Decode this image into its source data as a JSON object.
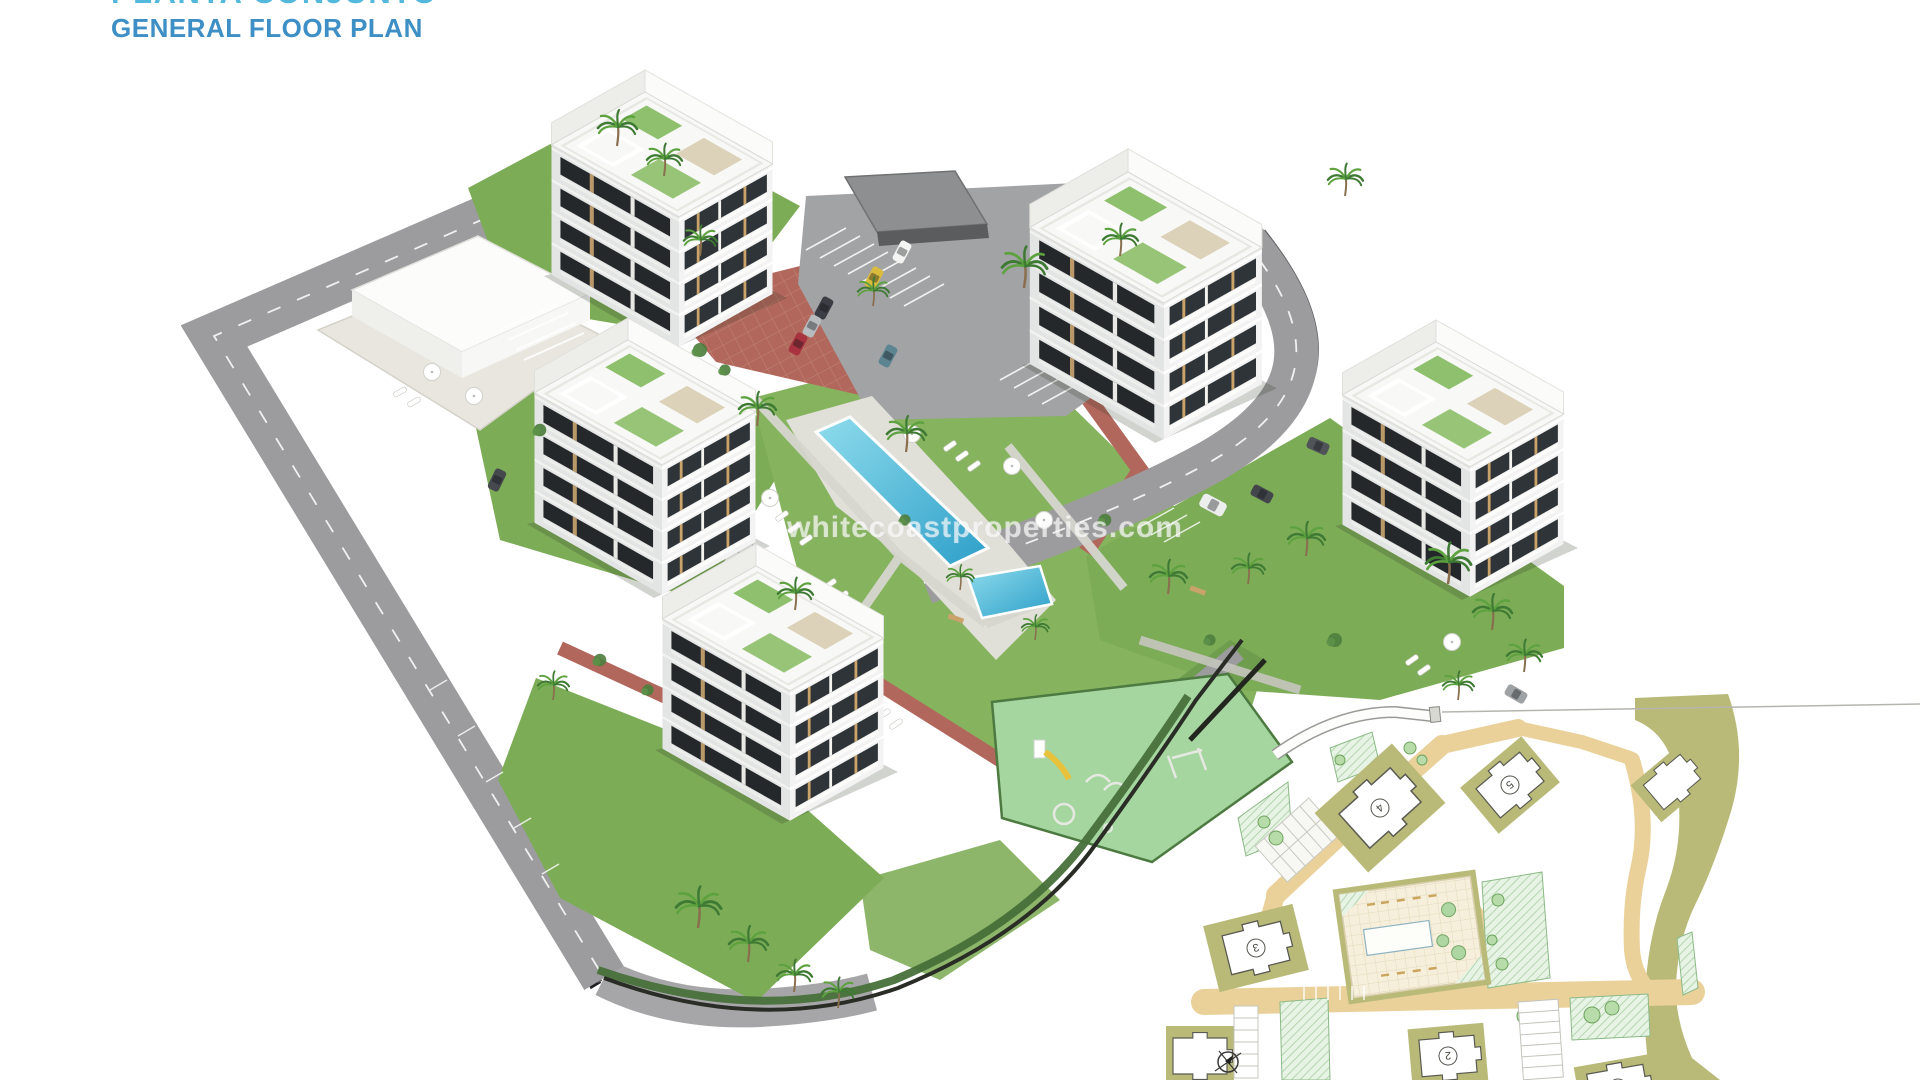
{
  "header": {
    "title_primary": "PLANTA CONJUNTO",
    "title_secondary": "GENERAL FLOOR PLAN"
  },
  "watermark": {
    "text": "whitecoastproperties.com"
  },
  "palette": {
    "title_primary_blue": "#52b8dc",
    "title_secondary_blue": "#3d8fc5",
    "grass_green": "#7dac57",
    "hedge_green": "#47703a",
    "playground_green": "#a6d6a0",
    "road_gray": "#9c9c9e",
    "brick_path_red": "#b2675c",
    "pool_water_blue": "#46b9dd",
    "building_white": "#f8f8f6",
    "plan_road_tan": "#ead19a",
    "plan_pad_khaki": "#b9ba78",
    "plan_hatch_green": "#cfe7cb",
    "car_yellow": "#d9bb3e",
    "car_red": "#a83240"
  },
  "icons": {
    "compass": "compass-icon"
  },
  "siteplan": {
    "buildings": [
      {
        "number": "1"
      },
      {
        "number": "2"
      },
      {
        "number": "3"
      },
      {
        "number": "4"
      },
      {
        "number": "5"
      }
    ]
  }
}
